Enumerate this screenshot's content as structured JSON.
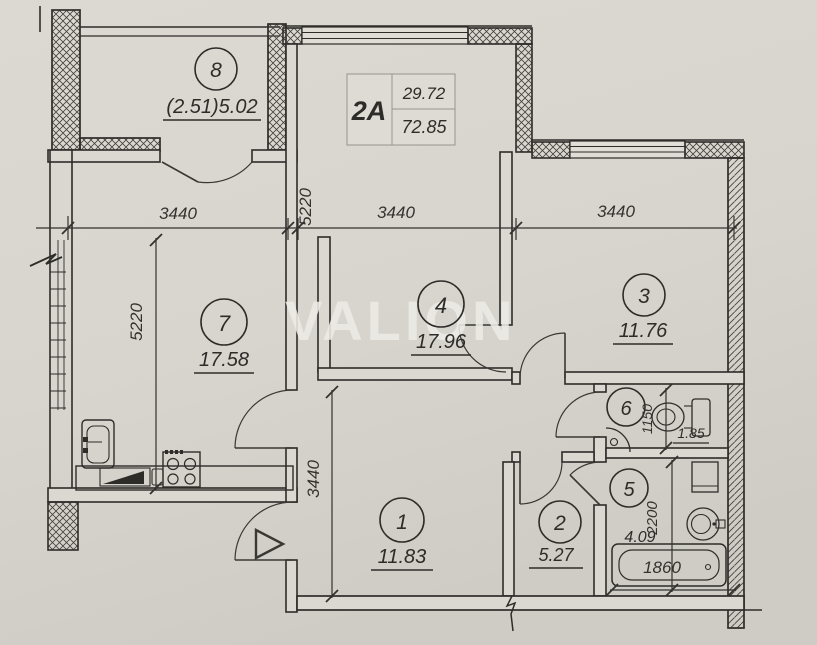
{
  "unit": {
    "label": "2A",
    "area_upper": "29.72",
    "area_lower": "72.85"
  },
  "watermark": "VALION",
  "rooms": {
    "r1": {
      "number": "1",
      "area": "11.83"
    },
    "r2": {
      "number": "2",
      "area": "5.27"
    },
    "r3": {
      "number": "3",
      "area": "11.76"
    },
    "r4": {
      "number": "4",
      "area": "17.96"
    },
    "r5": {
      "number": "5",
      "area": "4.09"
    },
    "r6": {
      "number": "6",
      "area": "1.85"
    },
    "r7": {
      "number": "7",
      "area": "17.58"
    },
    "r8": {
      "number": "8",
      "area": "(2.51)5.02"
    }
  },
  "dimensions": {
    "top_left_span": "3440",
    "top_center_span": "3440",
    "top_right_span": "3440",
    "top_vertical": "5220",
    "left_vertical": "5220",
    "hall_vertical": "3440",
    "wc_vertical": "1150",
    "bath_vertical": "2200",
    "bathtub_width": "1860"
  },
  "colors": {
    "paper": "#d8d5ce",
    "ink": "#2e2c29",
    "watermark": "#edebe6"
  }
}
